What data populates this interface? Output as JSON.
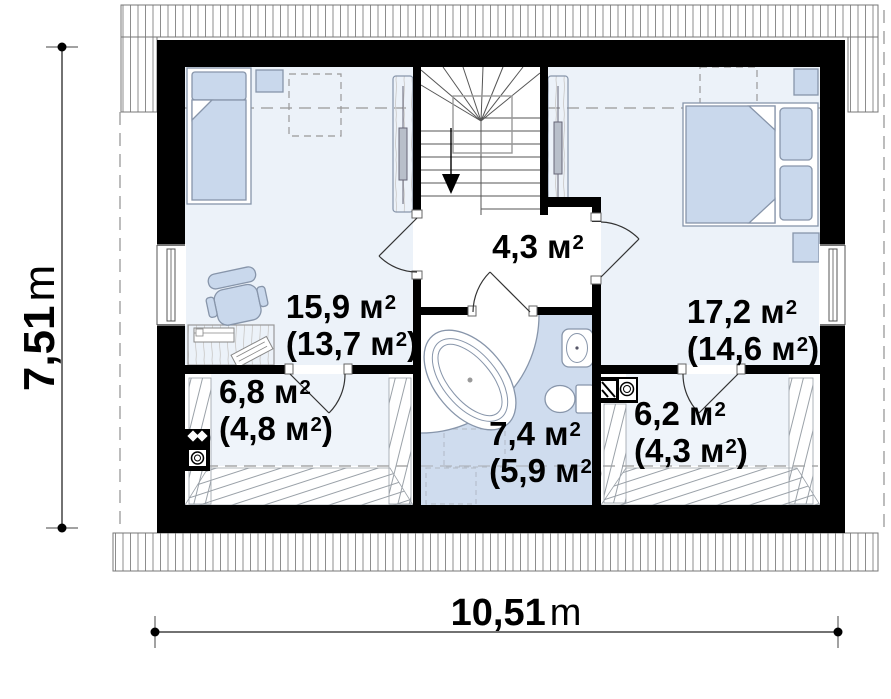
{
  "plan": {
    "rooms": [
      {
        "id": "bedroom-left",
        "gross": "15,9 м",
        "gross_sup": "2",
        "net": "(13,7 м",
        "net_sup": "2",
        "net_close": ")"
      },
      {
        "id": "hallway",
        "gross": "4,3 м",
        "gross_sup": "2"
      },
      {
        "id": "bedroom-right",
        "gross": "17,2 м",
        "gross_sup": "2",
        "net": "(14,6 м",
        "net_sup": "2",
        "net_close": ")"
      },
      {
        "id": "storage-left",
        "gross": "6,8 м",
        "gross_sup": "2",
        "net": "(4,8 м",
        "net_sup": "2",
        "net_close": ")"
      },
      {
        "id": "bathroom",
        "gross": "7,4 м",
        "gross_sup": "2",
        "net": "(5,9 м",
        "net_sup": "2",
        "net_close": ")"
      },
      {
        "id": "storage-right",
        "gross": "6,2 м",
        "gross_sup": "2",
        "net": "(4,3 м",
        "net_sup": "2",
        "net_close": ")"
      }
    ],
    "dimensions": {
      "height": {
        "value": "7,51",
        "unit": "m"
      },
      "width": {
        "value": "10,51",
        "unit": "m"
      }
    },
    "palette": {
      "wall": "#000000",
      "bedroom_floor": "#ecf2f9",
      "bathroom_floor": "#cfdcee",
      "furniture_fill": "#c9d8ec",
      "hatch_line": "#8d8d8d"
    }
  }
}
